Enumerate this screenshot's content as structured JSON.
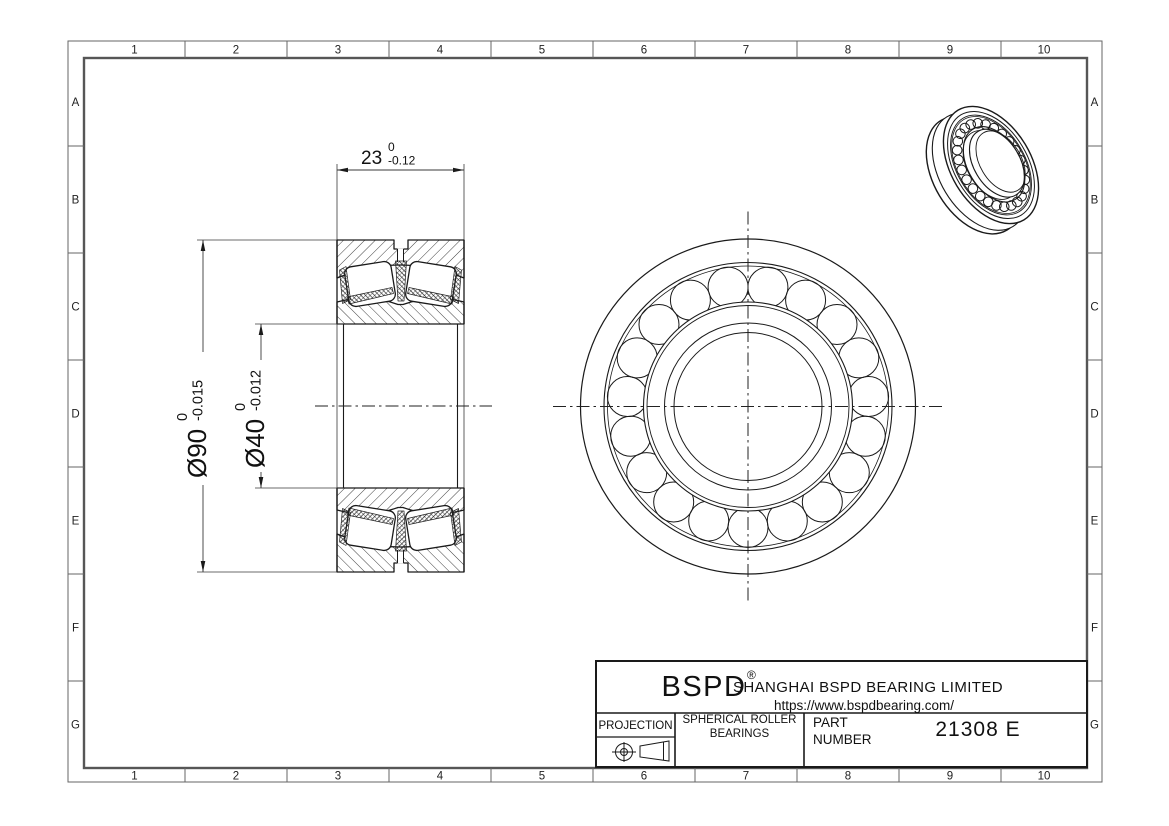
{
  "drawing": {
    "type": "engineering-drawing",
    "background": "#ffffff",
    "line_color": "#1a1a1a"
  },
  "grid": {
    "columns": [
      "1",
      "2",
      "3",
      "4",
      "5",
      "6",
      "7",
      "8",
      "9",
      "10"
    ],
    "rows": [
      "A",
      "B",
      "C",
      "D",
      "E",
      "F",
      "G"
    ]
  },
  "dimensions": {
    "width": {
      "text": "23",
      "tol_upper": "0",
      "tol_lower": "-0.12"
    },
    "outer_diameter": {
      "text": "Ø90",
      "tol_upper": "0",
      "tol_lower": "-0.015"
    },
    "bore": {
      "text": "Ø40",
      "tol_upper": "0",
      "tol_lower": "-0.012"
    }
  },
  "views": {
    "front_view": {
      "roller_count": 19
    },
    "iso_view": {
      "roller_count": 26
    }
  },
  "title_block": {
    "logo": "BSPD",
    "registered_mark": "®",
    "company": "SHANGHAI BSPD BEARING LIMITED",
    "website": "https://www.bspdbearing.com/",
    "projection_label": "PROJECTION",
    "product_type_line1": "SPHERICAL ROLLER",
    "product_type_line2": "BEARINGS",
    "part_label_line1": "PART",
    "part_label_line2": "NUMBER",
    "part_number": "21308 E"
  }
}
